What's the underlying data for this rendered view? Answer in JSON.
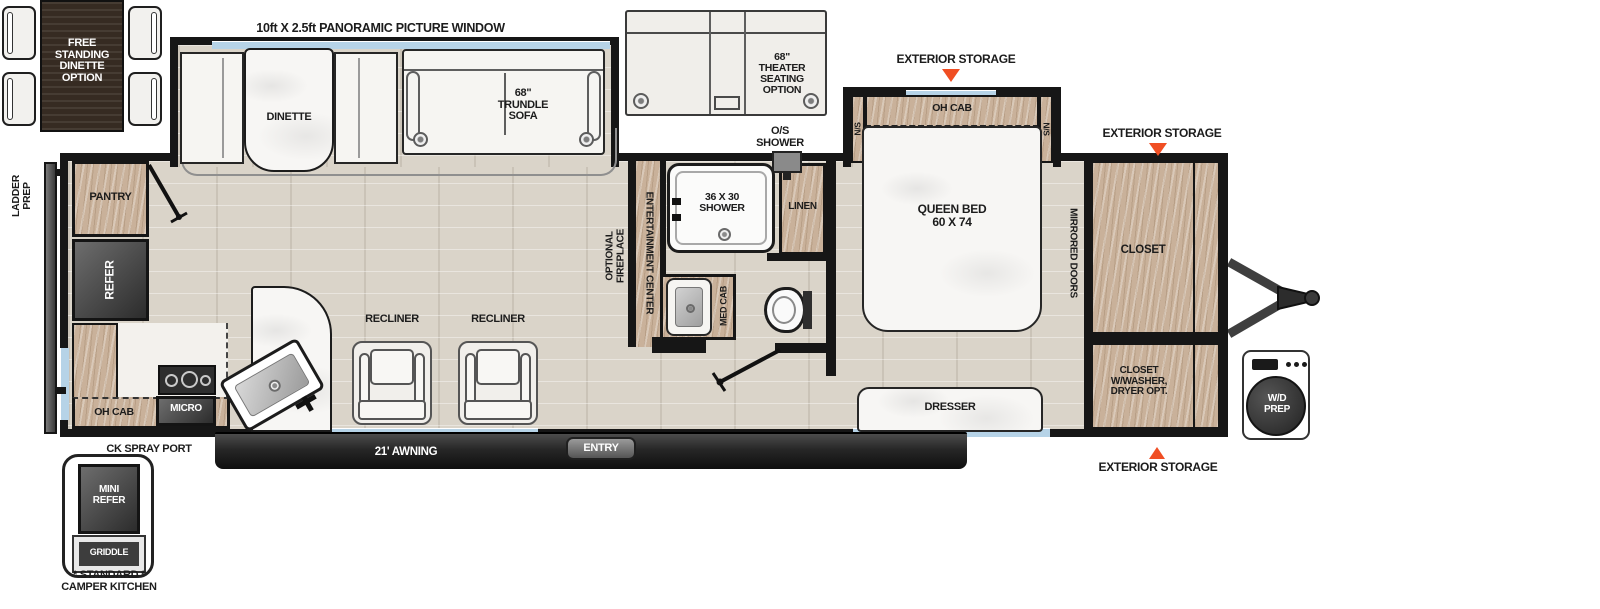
{
  "colors": {
    "accent_orange": "#f04e23",
    "wood": "#c9b19a",
    "wall": "#161616",
    "floor": "#dad4c9",
    "window_glass": "#b6d3e7",
    "appliance_dark": "#3f3f3f",
    "furniture_white": "#f6f5f2"
  },
  "header": {
    "panoramic_window": "10ft X 2.5ft PANORAMIC PICTURE WINDOW"
  },
  "exterior": {
    "storage_label": "EXTERIOR STORAGE",
    "os_shower": "O/S\nSHOWER",
    "ladder_prep": "LADDER\nPREP",
    "ck_spray_port": "CK SPRAY PORT",
    "awning": "21' AWNING",
    "entry": "ENTRY",
    "wd_prep": "W/D\nPREP"
  },
  "living": {
    "dinette": "DINETTE",
    "trundle_sofa": "68\"\nTRUNDLE\nSOFA",
    "recliner": "RECLINER",
    "entertainment_center": "ENTERTAINMENT CENTER",
    "optional_fireplace": "OPTIONAL\nFIREPLACE"
  },
  "kitchen": {
    "pantry": "PANTRY",
    "refer": "REFER",
    "oh_cab": "OH CAB",
    "micro": "MICRO"
  },
  "bath": {
    "shower_size": "36 X 30\nSHOWER",
    "linen": "LINEN",
    "med_cab": "MED CAB"
  },
  "bedroom": {
    "oh_cab": "OH CAB",
    "nightstand": "N/S",
    "queen_bed": "QUEEN BED\n60 X 74",
    "mirrored_doors": "MIRRORED DOORS",
    "closet": "CLOSET",
    "closet_washer": "CLOSET\nW/WASHER,\nDRYER OPT.",
    "dresser": "DRESSER"
  },
  "options": {
    "free_standing_dinette": "FREE\nSTANDING\nDINETTE\nOPTION",
    "theater_seating": "68\"\nTHEATER\nSEATING\nOPTION",
    "camper_kitchen": {
      "mini_refer": "MINI\nREFER",
      "griddle": "GRIDDLE",
      "caption": "* STANDARD *\nCAMPER KITCHEN"
    }
  }
}
